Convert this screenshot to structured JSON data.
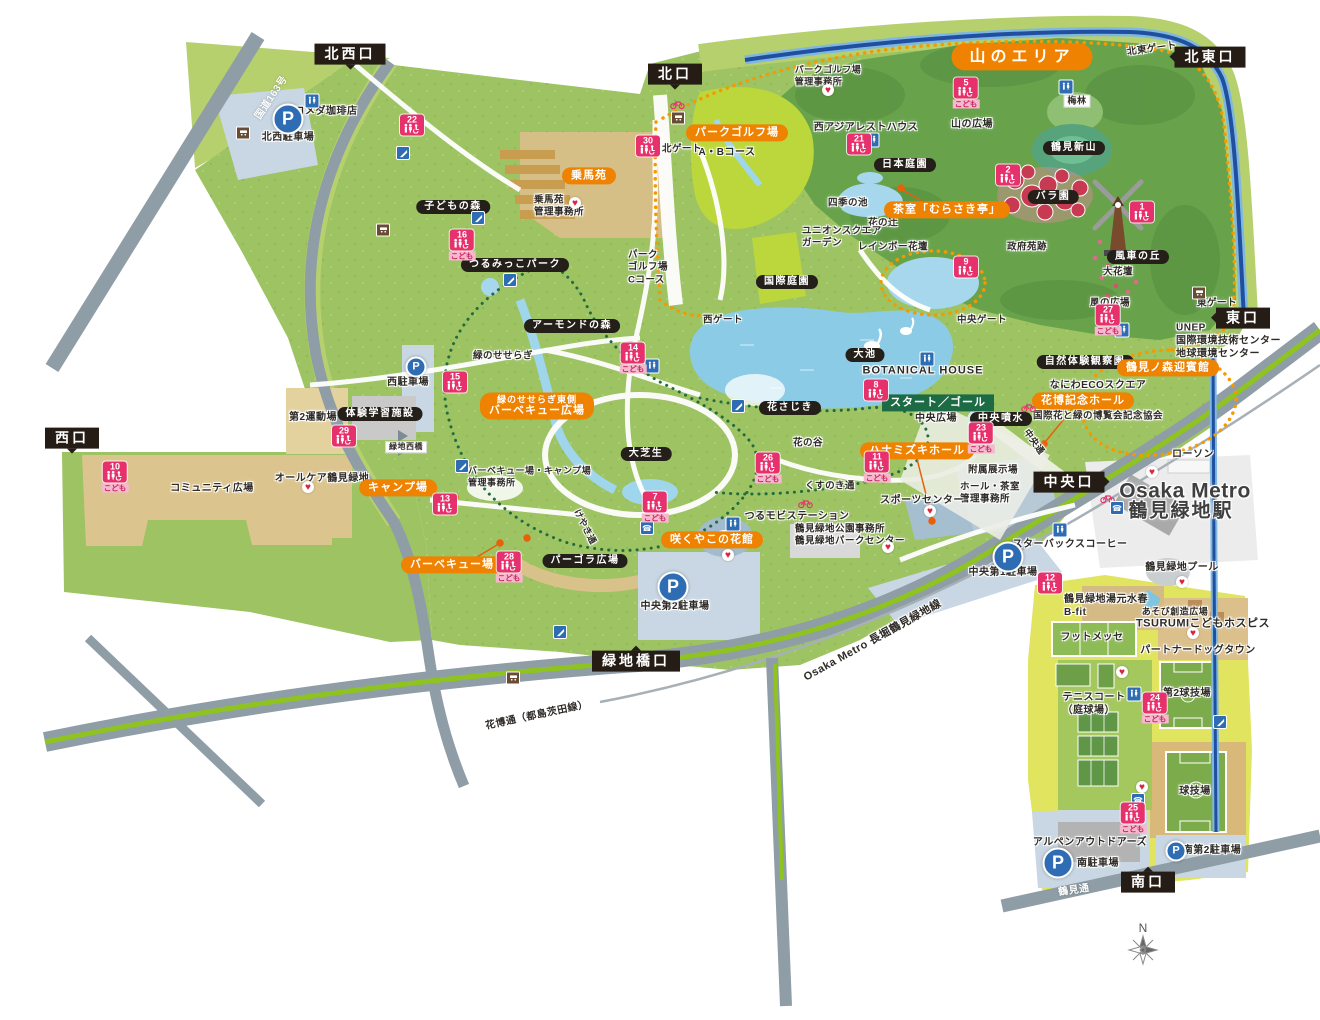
{
  "strings": {
    "parking": "P",
    "kodomo": "こども"
  },
  "colors": {
    "accent_orange": "#ef8200",
    "badge_black": "#242019",
    "toilet_pink": "#e7316d",
    "route_green": "#1d6b45",
    "water_blue": "#8ccbe6",
    "park_green": "#9dc363",
    "parking_blue": "#2e6db4",
    "canal_navy": "#1f4f9e",
    "road_gray": "#8e9da6",
    "median_green": "#8fc31f"
  },
  "entrances": [
    {
      "label": "北西口",
      "x": 350,
      "y": 54,
      "pt": "down"
    },
    {
      "label": "北口",
      "x": 675,
      "y": 74,
      "pt": "down"
    },
    {
      "label": "北東口",
      "x": 1210,
      "y": 57,
      "pt": "left"
    },
    {
      "label": "東口",
      "x": 1243,
      "y": 318,
      "pt": "left"
    },
    {
      "label": "西口",
      "x": 72,
      "y": 438,
      "pt": "down"
    },
    {
      "label": "中央口",
      "x": 1069,
      "y": 482,
      "pt": "right"
    },
    {
      "label": "緑地橋口",
      "x": 636,
      "y": 661,
      "pt": "up"
    },
    {
      "label": "南口",
      "x": 1148,
      "y": 882,
      "pt": "up"
    }
  ],
  "area_badges": [
    {
      "label": "山のエリア",
      "x": 1022,
      "y": 57,
      "big": true
    },
    {
      "label": "パークゴルフ場",
      "x": 737,
      "y": 133
    },
    {
      "label": "乗馬苑",
      "x": 589,
      "y": 176
    },
    {
      "label": "茶室「むらさき亭」",
      "x": 947,
      "y": 210
    },
    {
      "lines": [
        "緑のせせらぎ東側",
        "バーベキュー広場"
      ],
      "x": 537,
      "y": 406
    },
    {
      "label": "キャンプ場",
      "x": 398,
      "y": 488
    },
    {
      "label": "バーベキュー場",
      "x": 452,
      "y": 565
    },
    {
      "label": "咲くやこの花館",
      "x": 712,
      "y": 540
    },
    {
      "label": "ハナミズキホール",
      "x": 917,
      "y": 451
    },
    {
      "label": "花博記念ホール",
      "x": 1083,
      "y": 401
    },
    {
      "label": "鶴見ノ森迎賓館",
      "x": 1168,
      "y": 368
    }
  ],
  "facility_badges": [
    {
      "label": "子どもの森",
      "x": 453,
      "y": 207
    },
    {
      "label": "つるみっこパーク",
      "x": 515,
      "y": 265
    },
    {
      "label": "アーモンドの森",
      "x": 572,
      "y": 326
    },
    {
      "label": "体験学習施設",
      "x": 380,
      "y": 414
    },
    {
      "label": "日本庭園",
      "x": 905,
      "y": 165
    },
    {
      "label": "国際庭園",
      "x": 787,
      "y": 282
    },
    {
      "label": "大池",
      "x": 865,
      "y": 355
    },
    {
      "label": "花さじき",
      "x": 790,
      "y": 408
    },
    {
      "label": "中央噴水",
      "x": 1001,
      "y": 419
    },
    {
      "label": "自然体験観察園",
      "x": 1085,
      "y": 362
    },
    {
      "label": "鶴見新山",
      "x": 1074,
      "y": 148
    },
    {
      "label": "バラ園",
      "x": 1053,
      "y": 197
    },
    {
      "label": "風車の丘",
      "x": 1138,
      "y": 257
    },
    {
      "label": "パーゴラ広場",
      "x": 585,
      "y": 561
    },
    {
      "label": "大芝生",
      "x": 646,
      "y": 454
    }
  ],
  "route_badges": [
    {
      "label": "スタート／ゴール",
      "x": 938,
      "y": 403
    }
  ],
  "labels": [
    {
      "t": "コメダ珈琲店",
      "x": 326,
      "y": 112
    },
    {
      "t": "北西駐車場",
      "x": 288,
      "y": 138
    },
    {
      "t": "国道163号",
      "x": 272,
      "y": 98,
      "r": -56,
      "c": "w"
    },
    {
      "t": "A・Bコース",
      "x": 727,
      "y": 153
    },
    {
      "t": "北ゲート",
      "x": 682,
      "y": 149,
      "s": 9.5
    },
    {
      "lines": [
        "パークゴルフ場",
        "管理事務所"
      ],
      "x": 828,
      "y": 76,
      "s": 9
    },
    {
      "t": "西アジアレストハウス",
      "x": 866,
      "y": 128
    },
    {
      "t": "山の広場",
      "x": 972,
      "y": 125
    },
    {
      "t": "梅林",
      "x": 1077,
      "y": 101,
      "s": 9,
      "tag": true
    },
    {
      "t": "四季の池",
      "x": 848,
      "y": 203,
      "s": 9.5
    },
    {
      "t": "花の辻",
      "x": 883,
      "y": 223,
      "s": 9.5
    },
    {
      "lines": [
        "ユニオンスクエア",
        "ガーデン"
      ],
      "x": 802,
      "y": 238,
      "s": 9.5,
      "a": "left"
    },
    {
      "t": "レインボー花壇",
      "x": 893,
      "y": 247,
      "s": 9.5
    },
    {
      "t": "政府苑跡",
      "x": 1027,
      "y": 247,
      "s": 9.5
    },
    {
      "t": "大花壇",
      "x": 1118,
      "y": 272,
      "s": 9.5
    },
    {
      "t": "風の広場",
      "x": 1110,
      "y": 303,
      "s": 9.5
    },
    {
      "t": "北東ゲート",
      "x": 1152,
      "y": 49,
      "r": -8,
      "s": 9.5
    },
    {
      "t": "東ゲート",
      "x": 1217,
      "y": 303,
      "s": 9.5
    },
    {
      "t": "西ゲート",
      "x": 723,
      "y": 320,
      "s": 9.5
    },
    {
      "t": "中央ゲート",
      "x": 982,
      "y": 320,
      "s": 9.5
    },
    {
      "t": "BOTANICAL HOUSE",
      "x": 923,
      "y": 371,
      "s": 11,
      "ls": 1
    },
    {
      "t": "中央広場",
      "x": 936,
      "y": 419
    },
    {
      "lines": [
        "UNEP",
        "国際環境技術センター",
        "地球環境センター"
      ],
      "x": 1176,
      "y": 341,
      "a": "left"
    },
    {
      "t": "なにわECOスクエア",
      "x": 1098,
      "y": 386
    },
    {
      "t": "国際花と緑の博覧会記念協会",
      "x": 1098,
      "y": 416,
      "s": 9.5
    },
    {
      "t": "花の谷",
      "x": 808,
      "y": 443,
      "s": 9.5
    },
    {
      "t": "くすのき通",
      "x": 830,
      "y": 486,
      "s": 9.5
    },
    {
      "t": "附属展示場",
      "x": 993,
      "y": 470,
      "s": 9.5
    },
    {
      "lines": [
        "ホール・茶室",
        "管理事務所"
      ],
      "x": 960,
      "y": 494,
      "s": 9.5,
      "a": "left"
    },
    {
      "t": "スポーツセンター",
      "x": 922,
      "y": 501
    },
    {
      "t": "つるモビステーション",
      "x": 797,
      "y": 517
    },
    {
      "lines": [
        "鶴見緑地公園事務所",
        "鶴見緑地パークセンター"
      ],
      "x": 795,
      "y": 536,
      "s": 9.5,
      "a": "left"
    },
    {
      "t": "中央第1駐車場",
      "x": 1003,
      "y": 573
    },
    {
      "t": "スターバックスコーヒー",
      "x": 1070,
      "y": 545
    },
    {
      "t": "ローソン",
      "x": 1193,
      "y": 455
    },
    {
      "t": "Osaka Metro",
      "x": 1185,
      "y": 491,
      "s": 21,
      "b": 1,
      "col": "#3f3f3f"
    },
    {
      "t": "鶴見緑地駅",
      "x": 1181,
      "y": 512,
      "s": 19,
      "b": 1,
      "col": "#3f3f3f",
      "ls": 2
    },
    {
      "t": "鶴見緑地プール",
      "x": 1182,
      "y": 568
    },
    {
      "lines": [
        "鶴見緑地湯元水春",
        "B-fit"
      ],
      "x": 1064,
      "y": 606,
      "a": "left"
    },
    {
      "t": "あそび創造広場",
      "x": 1175,
      "y": 612,
      "s": 9
    },
    {
      "t": "TSURUMIこどもホスピス",
      "x": 1203,
      "y": 624,
      "s": 11
    },
    {
      "t": "パートナードッグタウン",
      "x": 1198,
      "y": 651
    },
    {
      "t": "フットメッセ",
      "x": 1092,
      "y": 638
    },
    {
      "lines": [
        "テニスコート",
        "（庭球場）"
      ],
      "x": 1094,
      "y": 704
    },
    {
      "t": "第2球技場",
      "x": 1187,
      "y": 694
    },
    {
      "t": "球技場",
      "x": 1195,
      "y": 792
    },
    {
      "t": "アルペンアウトドアーズ",
      "x": 1090,
      "y": 843
    },
    {
      "t": "南駐車場",
      "x": 1098,
      "y": 864
    },
    {
      "t": "南第2駐車場",
      "x": 1212,
      "y": 851
    },
    {
      "t": "鶴見通",
      "x": 1074,
      "y": 891,
      "c": "w",
      "r": -8
    },
    {
      "t": "花博通（都島茨田線）",
      "x": 537,
      "y": 716,
      "r": -12
    },
    {
      "t": "Osaka Metro 長堀鶴見緑地線",
      "x": 873,
      "y": 641,
      "r": -29,
      "s": 11
    },
    {
      "t": "けやき通",
      "x": 585,
      "y": 527,
      "r": 63,
      "s": 9
    },
    {
      "t": "中央通",
      "x": 1034,
      "y": 442,
      "r": 55,
      "s": 9
    },
    {
      "t": "緑地西橋",
      "x": 406,
      "y": 447,
      "s": 8,
      "tag": true
    },
    {
      "t": "第2運動場",
      "x": 313,
      "y": 418
    },
    {
      "t": "オールケア鶴見緑地",
      "x": 322,
      "y": 479
    },
    {
      "t": "コミュニティ広場",
      "x": 212,
      "y": 489
    },
    {
      "t": "西駐車場",
      "x": 408,
      "y": 383
    },
    {
      "t": "中央第2駐車場",
      "x": 675,
      "y": 607
    },
    {
      "t": "緑のせせらぎ",
      "x": 503,
      "y": 356,
      "s": 9.5
    },
    {
      "lines": [
        "パーク",
        "ゴルフ場",
        "Cコース"
      ],
      "x": 628,
      "y": 268,
      "s": 9.5,
      "a": "left"
    },
    {
      "lines": [
        "乗馬苑",
        "管理事務所"
      ],
      "x": 534,
      "y": 207,
      "s": 9.5,
      "a": "left"
    },
    {
      "lines": [
        "バーベキュー場・キャンプ場",
        "管理事務所"
      ],
      "x": 468,
      "y": 477,
      "s": 9,
      "a": "left"
    }
  ],
  "toilets": [
    {
      "n": 22,
      "x": 412,
      "y": 125
    },
    {
      "n": 16,
      "x": 462,
      "y": 245,
      "k": 1
    },
    {
      "n": 30,
      "x": 648,
      "y": 146
    },
    {
      "n": 5,
      "x": 966,
      "y": 93,
      "k": 1
    },
    {
      "n": 21,
      "x": 859,
      "y": 144
    },
    {
      "n": 2,
      "x": 1008,
      "y": 175
    },
    {
      "n": 1,
      "x": 1142,
      "y": 212
    },
    {
      "n": 27,
      "x": 1108,
      "y": 320,
      "k": 1
    },
    {
      "n": 9,
      "x": 966,
      "y": 267
    },
    {
      "n": 15,
      "x": 455,
      "y": 382
    },
    {
      "n": 29,
      "x": 344,
      "y": 436
    },
    {
      "n": 10,
      "x": 115,
      "y": 477,
      "k": 1
    },
    {
      "n": 13,
      "x": 445,
      "y": 504
    },
    {
      "n": 28,
      "x": 509,
      "y": 567,
      "k": 1
    },
    {
      "n": 7,
      "x": 655,
      "y": 507,
      "k": 1
    },
    {
      "n": 26,
      "x": 768,
      "y": 468,
      "k": 1
    },
    {
      "n": 11,
      "x": 877,
      "y": 467,
      "k": 1
    },
    {
      "n": 8,
      "x": 876,
      "y": 390
    },
    {
      "n": 23,
      "x": 981,
      "y": 438,
      "k": 1
    },
    {
      "n": 14,
      "x": 633,
      "y": 358,
      "k": 1
    },
    {
      "n": 12,
      "x": 1050,
      "y": 583
    },
    {
      "n": 24,
      "x": 1155,
      "y": 708,
      "k": 1
    },
    {
      "n": 25,
      "x": 1133,
      "y": 818,
      "k": 1
    }
  ],
  "parking": [
    {
      "x": 288,
      "y": 119,
      "big": true
    },
    {
      "x": 416,
      "y": 367
    },
    {
      "x": 673,
      "y": 587,
      "big": true
    },
    {
      "x": 1008,
      "y": 557,
      "big": true
    },
    {
      "x": 1058,
      "y": 863,
      "big": true
    },
    {
      "x": 1176,
      "y": 851
    }
  ],
  "icons": {
    "wc": [
      [
        312,
        101
      ],
      [
        872,
        140
      ],
      [
        927,
        359
      ],
      [
        1060,
        530
      ],
      [
        1134,
        694
      ],
      [
        652,
        366
      ],
      [
        733,
        524
      ],
      [
        1066,
        87
      ],
      [
        1122,
        330
      ]
    ],
    "aed": [
      [
        828,
        90
      ],
      [
        575,
        203
      ],
      [
        728,
        555
      ],
      [
        930,
        511
      ],
      [
        1182,
        582
      ],
      [
        1152,
        472
      ],
      [
        888,
        547
      ],
      [
        1193,
        633
      ],
      [
        1142,
        787
      ],
      [
        1122,
        672
      ],
      [
        308,
        487
      ]
    ],
    "bus": [
      [
        243,
        133
      ],
      [
        383,
        230
      ],
      [
        513,
        678
      ],
      [
        1199,
        293
      ],
      [
        678,
        118
      ]
    ],
    "bike": [
      [
        677,
        104
      ],
      [
        805,
        503
      ],
      [
        1107,
        498
      ],
      [
        1028,
        407
      ]
    ],
    "pg": [
      [
        403,
        153
      ],
      [
        478,
        218
      ],
      [
        510,
        280
      ],
      [
        560,
        632
      ],
      [
        738,
        406
      ],
      [
        462,
        466
      ],
      [
        1220,
        722
      ]
    ],
    "ph": [
      [
        1117,
        508
      ],
      [
        1138,
        800
      ],
      [
        647,
        528
      ]
    ]
  },
  "compass": {
    "label": "N"
  }
}
